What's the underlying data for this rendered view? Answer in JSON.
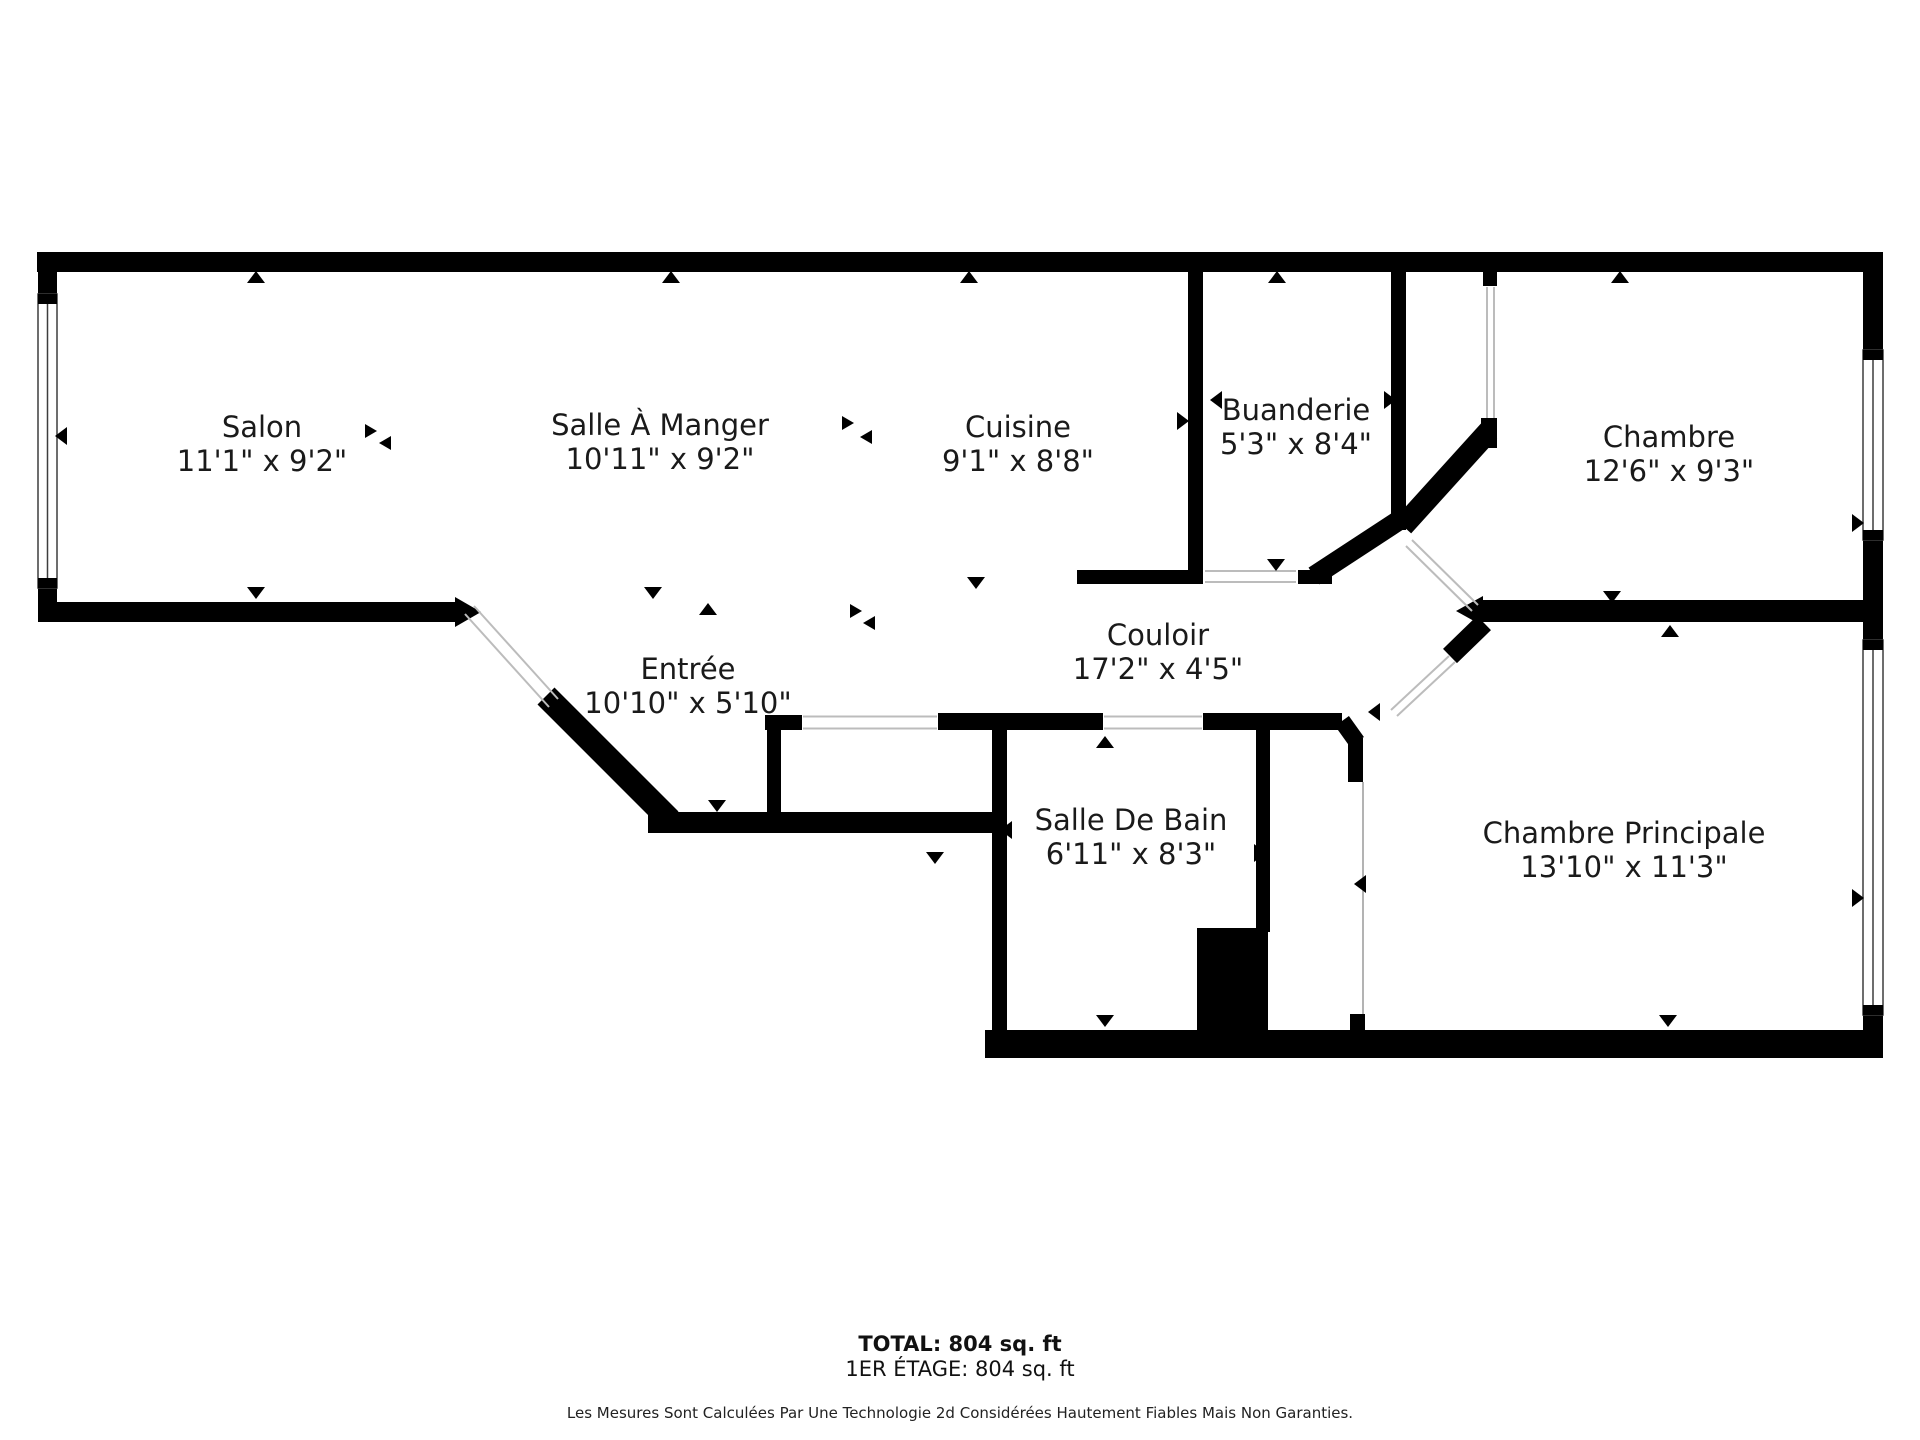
{
  "floorplan": {
    "rooms": [
      {
        "id": "salon",
        "name": "Salon",
        "dimensions": "11'1\" x 9'2\""
      },
      {
        "id": "salle-a-manger",
        "name": "Salle À Manger",
        "dimensions": "10'11\" x 9'2\""
      },
      {
        "id": "cuisine",
        "name": "Cuisine",
        "dimensions": "9'1\" x 8'8\""
      },
      {
        "id": "buanderie",
        "name": "Buanderie",
        "dimensions": "5'3\" x 8'4\""
      },
      {
        "id": "chambre",
        "name": "Chambre",
        "dimensions": "12'6\" x 9'3\""
      },
      {
        "id": "entree",
        "name": "Entrée",
        "dimensions": "10'10\" x 5'10\""
      },
      {
        "id": "couloir",
        "name": "Couloir",
        "dimensions": "17'2\" x 4'5\""
      },
      {
        "id": "salle-de-bain",
        "name": "Salle De Bain",
        "dimensions": "6'11\" x 8'3\""
      },
      {
        "id": "chambre-principale",
        "name": "Chambre Principale",
        "dimensions": "13'10\" x 11'3\""
      }
    ],
    "footer": {
      "total": "TOTAL: 804 sq. ft",
      "floor": "1ER ÉTAGE: 804 sq. ft",
      "disclaimer": "Les Mesures Sont Calculées Par Une Technologie 2d Considérées Hautement Fiables Mais Non Garanties."
    },
    "colors": {
      "wall": "#000000",
      "door_swing": "#bcbcbc",
      "window_frame": "#3d3d3d",
      "text": "#1a1a1a"
    }
  }
}
